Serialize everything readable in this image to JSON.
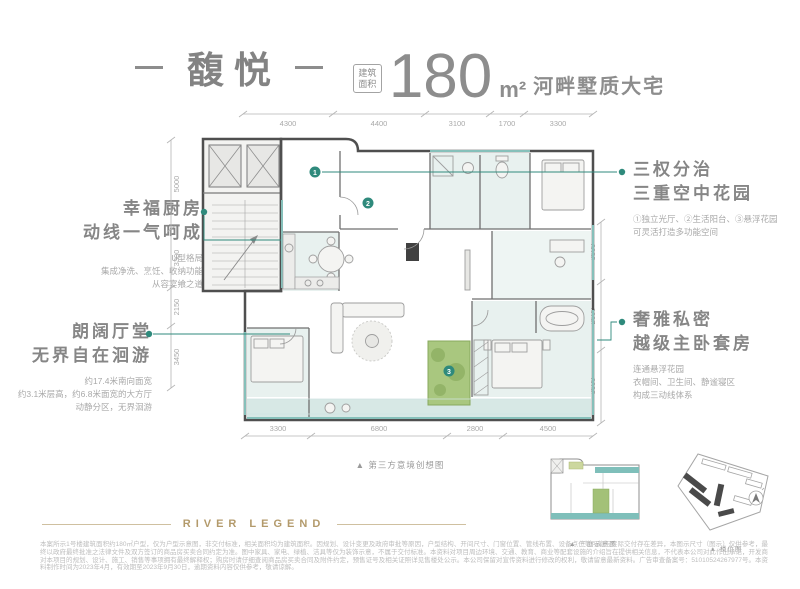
{
  "header": {
    "title": "馥悦",
    "badge": [
      "建筑",
      "面积"
    ],
    "area_number": "180",
    "area_unit": "m²",
    "tagline": "河畔墅质大宅"
  },
  "annotations": {
    "left": [
      {
        "heading": [
          "幸福厨房",
          "动线一气呵成"
        ],
        "sub": [
          "U型格局",
          "集成净洗、烹饪、收纳功能",
          "从容宴飨之道"
        ]
      },
      {
        "heading": [
          "朗阔厅堂",
          "无界自在洄游"
        ],
        "sub": [
          "约17.4米南向面宽",
          "约3.1米层高，约6.8米面宽的大方厅",
          "动静分区，无界洄游"
        ]
      }
    ],
    "right": [
      {
        "heading": [
          "三权分治",
          "三重空中花园"
        ],
        "sub": [
          "①独立光厅、②生活阳台、③悬浮花园",
          "可灵活打造多功能空间"
        ]
      },
      {
        "heading": [
          "奢雅私密",
          "越级主卧套房"
        ],
        "sub": [
          "连通悬浮花园",
          "衣帽间、卫生间、静谧寝区",
          "构成三动线体系"
        ]
      }
    ]
  },
  "plan": {
    "dims": {
      "top": [
        "4300",
        "4400",
        "3100",
        "1700",
        "3300"
      ],
      "bottom": [
        "3300",
        "6800",
        "2800",
        "4500"
      ],
      "left": [
        "5000",
        "3300",
        "2150",
        "3450"
      ],
      "right": [
        "3500",
        "2600",
        "3600"
      ]
    },
    "markers": [
      "1",
      "2",
      "3"
    ]
  },
  "caption_main": "▲ 第三方意境创想图",
  "mini": {
    "caption": "▲ 三庭示意图"
  },
  "site": {
    "caption": "▲ 楼位图"
  },
  "footer": {
    "brand": "RIVER LEGEND",
    "disclaimer": "本案所示1号楼建筑面积约180㎡户型，仅为户型示意图，非交付标准，相关面积均为建筑面积。因规划、设计变更及政府审批等原因，户型结构、开间尺寸、门窗位置、管线布置、设备点位等可能与实际交付存在差异，本图示尺寸（图示）仅供参考，最终以政府最终批准之法律文件及双方签订的商品房买卖合同约定为准。图中家具、家电、绿植、洁具等仅为装饰示意，不属于交付标准。本资料对项目周边环境、交通、教育、商业等配套设施的介绍旨在提供相关信息，不代表本公司对此作出承诺，开发商对本项目的规划、设计、施工、销售等事项拥有最终解释权；购房时请仔细查阅商品房买卖合同及附件约定，预售证号及相关证照详见售楼处公示。本公司保留对宣传资料进行修改的权利，敬请留意最新资料。广告审查备案号：51010524267977号。本资料制作时间为2023年4月，有效期至2023年9月30日，逾期资料内容仅供参考，敬请谅解。"
  },
  "colors": {
    "accent_teal": "#2f8a7c",
    "window_teal": "#86c0ba",
    "garden_green": "#a3c178",
    "brand_gold": "#b39a6b",
    "heading_gray": "#868686",
    "dim_gray": "#b5b5b5"
  }
}
